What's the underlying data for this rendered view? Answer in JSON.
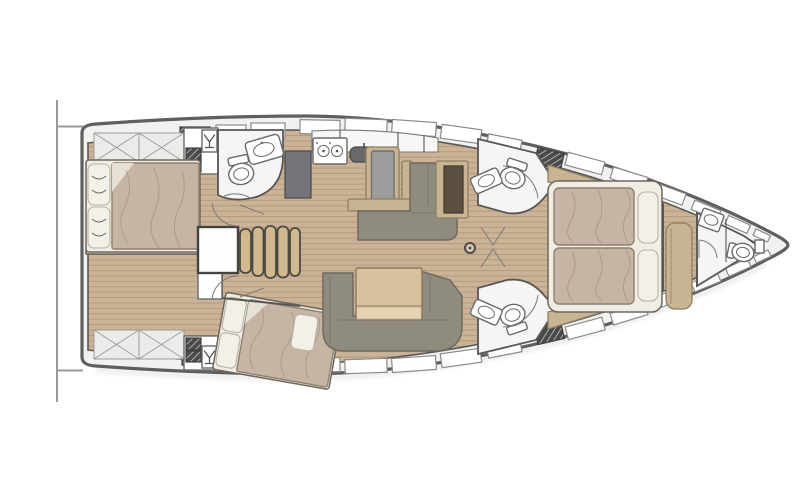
{
  "diagram": {
    "type": "yacht-interior-floor-plan",
    "orientation": "bow-right",
    "vessel": "sailing yacht monohull",
    "rooms": [
      {
        "id": "aft-cabin-starboard",
        "label": "Aft double cabin (top)",
        "floor": "wood"
      },
      {
        "id": "aft-cabin-port",
        "label": "Aft double cabin (bottom, angled bed)",
        "floor": "wood"
      },
      {
        "id": "aft-head",
        "label": "Aft head with toilet and washbasin",
        "floor": "white"
      },
      {
        "id": "companionway",
        "label": "Companionway entry steps",
        "floor": "white"
      },
      {
        "id": "galley",
        "label": "Galley with stove, sink and cabinets",
        "floor": "wood"
      },
      {
        "id": "saloon",
        "label": "Saloon with L-sofa and folding table",
        "floor": "wood"
      },
      {
        "id": "nav-desk",
        "label": "Chart table desk",
        "floor": "wood"
      },
      {
        "id": "mid-head-top",
        "label": "Forward head (top)",
        "floor": "white"
      },
      {
        "id": "mid-head-bottom",
        "label": "Forward head (bottom)",
        "floor": "white"
      },
      {
        "id": "owner-cabin",
        "label": "Forward owner cabin with island bed and bench",
        "floor": "wood"
      },
      {
        "id": "bow-head",
        "label": "Bow head / shower compartment",
        "floor": "white"
      }
    ],
    "fixtures": [
      "double-bed-starboard-aft",
      "double-bed-port-aft-angled",
      "island-double-bed-forward",
      "companionway-steps-5",
      "stove-two-burners",
      "galley-sink",
      "galley-island-counter",
      "dark-cabinet",
      "chart-desk",
      "saloon-l-sofa",
      "saloon-table",
      "dinette-u-sofa",
      "toilet-aft-head",
      "washbasin-aft-head",
      "toilet-mid-head-top",
      "washbasin-mid-head-top",
      "toilet-mid-head-bottom",
      "washbasin-mid-head-bottom",
      "toilet-bow-head",
      "washbasin-bow-head",
      "bench-seat-forward",
      "mast-foot",
      "wet-bar-glass-top",
      "wet-bar-glass-bottom",
      "deck-hatches",
      "hull-windows",
      "storage-x-lockers",
      "swim-platform-transom"
    ]
  },
  "colors": {
    "deckFill": "#f1f1ef",
    "hullStroke": "#5f5f5f",
    "wallStroke": "#575757",
    "winStroke": "#8b8b8b",
    "wood": "#ccb296",
    "woodLine": "#b49a7d",
    "roomFloor": "#f5f5f3",
    "xcellFill": "#ebebe9",
    "xcellLine": "#9b9b9b",
    "sofaGray": "#8f8b7e",
    "sofaGrayDark": "#6f6b5f",
    "counterGray": "#9d9d9b",
    "cabinetDark": "#73737a",
    "sinkDark": "#696969",
    "deskDark": "#5c4f40",
    "trimTan": "#c8b392",
    "tableWood": "#d9c19d",
    "tableWoodLight": "#e5d3b2",
    "stepsWood": "#d2b88f",
    "mattress": "#c6b5a4",
    "mattressLine": "#a18f7b",
    "bedFrame": "#f0ede5",
    "pillow": "#f3f0e8",
    "pillowStroke": "#b9b2a4",
    "fixtureStroke": "#6a6a6a",
    "hatchDark": "#4a4a4a"
  }
}
